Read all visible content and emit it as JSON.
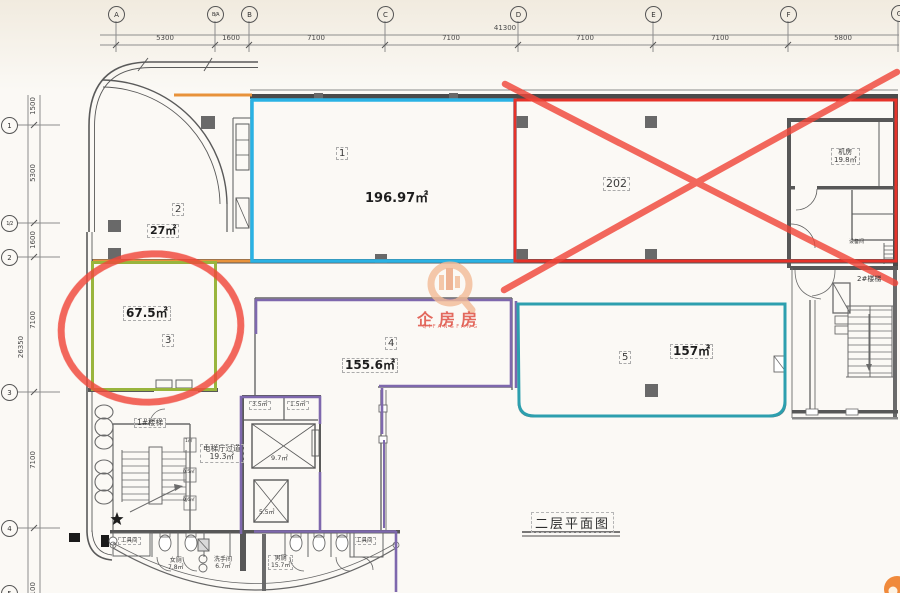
{
  "title": {
    "text": "二层平面图"
  },
  "watermark": {
    "logo": "qifangfang-logo",
    "text": "企房房",
    "subtext": "QIFANGFANG"
  },
  "grid": {
    "top_letters": [
      "A",
      "B/A",
      "B",
      "C",
      "D",
      "E",
      "F",
      "G"
    ],
    "top_dims": [
      "5300",
      "1600",
      "7100",
      "7100",
      "7100",
      "7100",
      "5800"
    ],
    "top_total": "41300",
    "left_numbers": [
      "1",
      "1/2",
      "2",
      "3",
      "4",
      "5"
    ],
    "left_dims": [
      "1500",
      "5300",
      "1600",
      "7100",
      "7100",
      "7100"
    ],
    "left_total": "26350"
  },
  "rooms": {
    "r1": {
      "num": "1",
      "area": "196.97㎡",
      "outline": "#2ab2e4"
    },
    "r2": {
      "num": "2",
      "area": "27㎡"
    },
    "r3": {
      "num": "3",
      "area": "67.5㎡",
      "outline": "#99b53d"
    },
    "r4": {
      "num": "4",
      "area": "155.6㎡",
      "outline": "#7e68ad"
    },
    "r5": {
      "num": "5",
      "area": "157㎡",
      "outline": "#2d9fae"
    },
    "r202": {
      "num": "202",
      "outline": "#e63229"
    }
  },
  "labels": {
    "machine_room": {
      "name": "机房",
      "area": "19.8㎡"
    },
    "equipment_room": "设备间",
    "stair2": "2#楼梯",
    "stair1": "1#楼梯",
    "elevator_lobby": {
      "name": "电梯厅过道",
      "area": "19.3㎡"
    },
    "shaft_a": "3.5㎡",
    "shaft_b": "1.5㎡",
    "elevator_main": "9.7㎡",
    "elevator_small": "5.5㎡",
    "duct_a": "1㎡",
    "duct_b": "0.5㎡",
    "duct_c": "0.6㎡",
    "tool_room_left": "工具间",
    "tool_room_right": "工具间",
    "female_wc": {
      "name": "女厕",
      "area": "7.8㎡"
    },
    "washroom": {
      "name": "洗手间",
      "area": "6.7㎡"
    },
    "male_wc": {
      "name": "男厕",
      "area": "15.7㎡"
    }
  },
  "annotation_colors": {
    "hand_drawn_red": "#f0473b",
    "box_red": "#e63229",
    "cyan": "#2ab2e4",
    "green": "#99b53d",
    "purple": "#7e68ad",
    "teal": "#2d9fae",
    "orange": "#e8923a",
    "watermark_orange": "#f3bb97"
  }
}
